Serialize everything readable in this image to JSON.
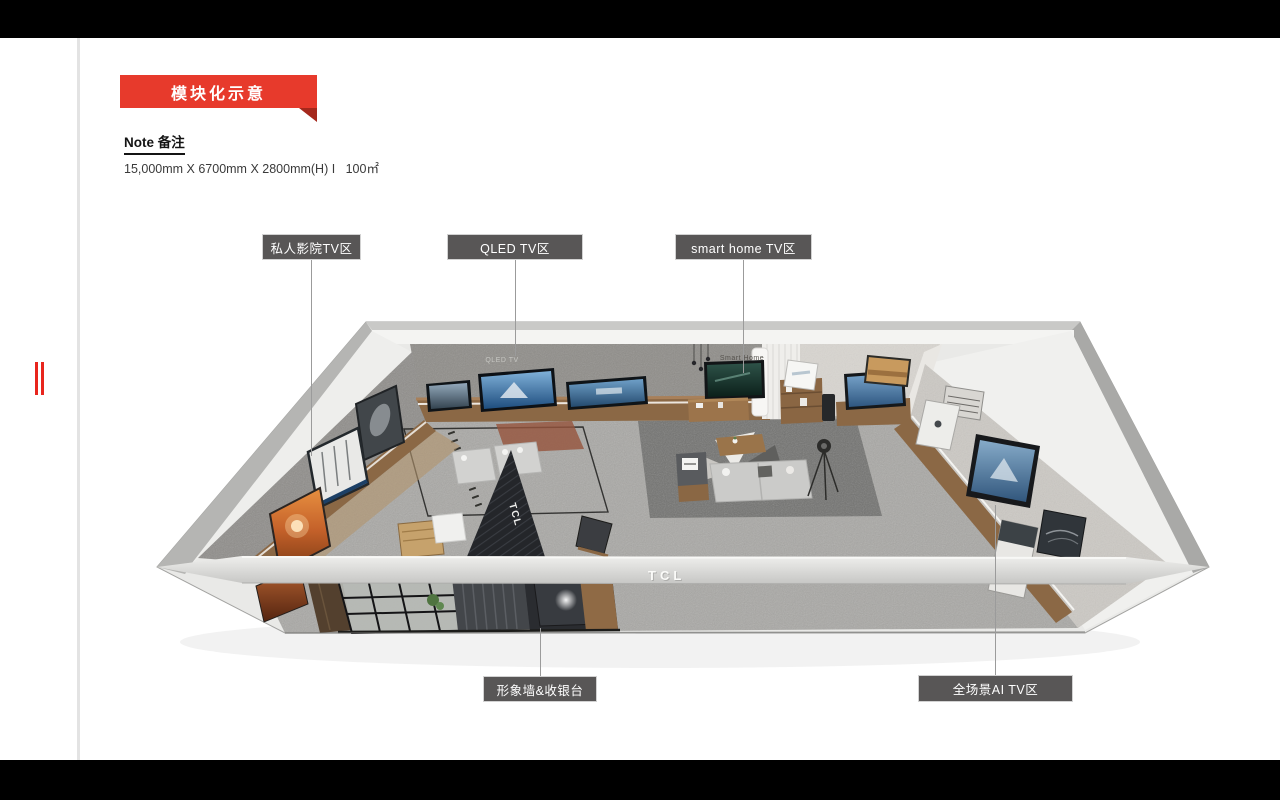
{
  "slide": {
    "banner_title": "模块化示意",
    "note_heading": "Note 备注",
    "dimensions_line": "15,000mm X 6700mm X 2800mm(H) I   100㎡"
  },
  "zone_labels": {
    "private_cinema": "私人影院TV区",
    "qled": "QLED TV区",
    "smart_home": "smart home TV区",
    "image_wall_cashier": "形象墙&收银台",
    "full_scene_ai": "全场景AI TV区"
  },
  "showroom_signage": {
    "qled_wall_sign": "QLED TV",
    "smart_home_wall_sign": "Smart Home",
    "front_beam_logo": "TCL",
    "feature_wall_logo": "TCL"
  },
  "colors": {
    "banner_red": "#e73a2c",
    "banner_fold_red": "#a5281c",
    "label_gray": "#585656",
    "registration_mark_red": "#e8251d",
    "carpet_gray": "#a9a8a5",
    "wood_brown": "#8b6845"
  }
}
